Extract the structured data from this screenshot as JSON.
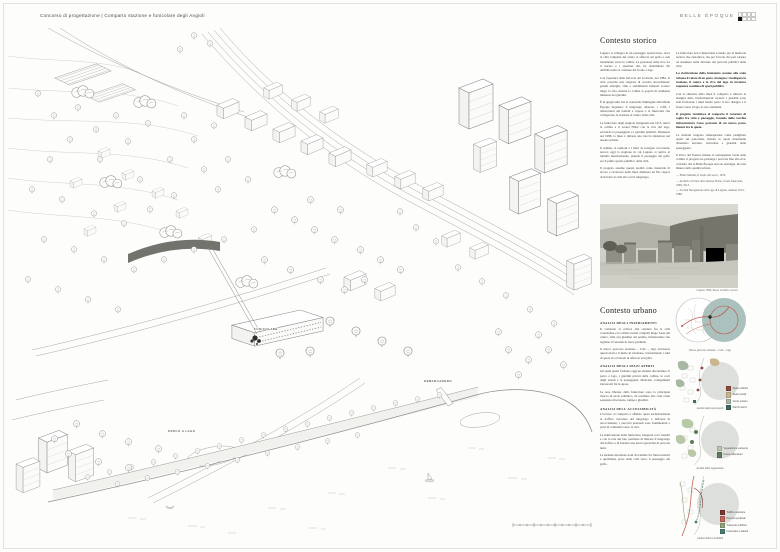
{
  "page": {
    "title": "Concorso di progettazione | Comparto stazione e funicolare degli Angioli",
    "motto": "BELLE ÉPOQUE"
  },
  "drawing": {
    "labels": {
      "funicolare": "FUNICOLARE",
      "debarcadero": "DEBARCADERO",
      "parco": "PARCO A LAGO"
    }
  },
  "historic": {
    "heading": "Contesto storico",
    "col1": [
      "Lugano si sviluppa in un paesaggio spettacolare, dove la città compatta del centro si affaccia sul golfo e sale lentamente verso le colline. La posizione della riva, tra il nucleo e i quartieri alti, ha determinato fin dall'Ottocento il carattere del fronte a lago.",
      "Con l'apertura della ferrovia del Gottardo, nel 1882, la città conobbe una stagione di crescita straordinaria: grandi alberghi, ville e stabilimenti balneari sorsero lungo la riva, mentre la collina si popolò di residenze immerse nei giardini.",
      "È in quegli anni che si consolida l'immagine della Belle Époque luganese: il lungolago alberato, i caffè, i debarcaderi dei battelli a vapore e le funicolari che collegavano la stazione al centro della città.",
      "La funicolare degli Angioli, inaugurata nel 1913, univa la collina e il Grand Hôtel con la riva del lago, servendo la passeggiata e i giardini pubblici. Dismessa nel 1986, la linea è rimasta una traccia silenziosa nel tessuto urbano.",
      "Il sedime, le stazioni e i muri di sostegno raccontano ancora oggi la stagione in cui Lugano si apriva al turismo internazionale, quando il paesaggio del golfo era il primo spazio pubblico della città.",
      "Il progetto assume questa eredità come materiale di lavoro e riconosce nella linea dismessa un filo capace di ricucire la città alta con il lungolago."
    ],
    "col2": [
      "La funicolare non è importante soltanto per la memoria tecnica che custodisce, ma per il ruolo che può tornare ad assumere nella struttura dei percorsi pubblici della città.",
      "La riattivazione della funicolare assume alla scala urbana il valore di un gesto strategico: ricollegare la stazione, il centro e la riva del lago in un'unica sequenza continua di spazi pubblici.",
      "Con la chiusura della linea il comparto è rimasto ai margini delle trasformazioni recenti: i giardini sono stati frazionati, i muri hanno perso il loro disegno e il fronte verso il lago la sua continuità.",
      "Il progetto restituisce al comparto il carattere di soglia fra città e paesaggio, facendo della vecchia infrastruttura l'asse portante di un nuovo parco lineare fra le quote.",
      "Le stazioni vengono reinterpretate come padiglioni aperti sul panorama, mentre le quote intermedie diventano terrazze, belvedere e giardini della passeggiata.",
      "Il Parco del Tassino rimane il contrappunto verde sulla collina: il progetto ne prolunga i percorsi fino alla riva, convinto che la Belle Époque non sia nostalgia, ma una misura della qualità urbana."
    ],
    "footnotes": [
      "— Plinio Martini, Il fondo del sacco, 1970.",
      "— Archivio di Stato del Cantone Ticino, fondo funicolari, 1899–1913.",
      "— Società Navigazione del Lago di Lugano, annuari 1913–1986."
    ],
    "photo_caption": "Lugano 1899, Photo Archivio storico"
  },
  "urban": {
    "heading": "Contesto urbano",
    "s1_title": "ANALISI DEGLI INSEDIAMENTI",
    "s1": [
      "Il comparto si colloca alla cerniera fra la città consolidata e la collina: isolati compatti lungo l'asse del centro, ville con giardino sul pendio, infrastrutture che tagliano il versante in fasce parallele.",
      "Il nuovo percorso stazione – CAC – lago attraversa questi strati e li mette in relazione, trasformando i salti di quota in occasioni di affaccio sul golfo."
    ],
    "s2_title": "ANALISI DEGLI SPAZI APERTI",
    "s2": [
      "Gli spazi aperti formano oggi un sistema discontinuo: il parco a lago, i giardini privati della collina, le corti degli isolati e la passeggiata. Mancano collegamenti trasversali fra le quote.",
      "Le aree liberate dalla funicolare sono la principale riserva di suolo pubblico, da restituire alla città come sequenza di terrazze, rampe e giardini."
    ],
    "s3_title": "ANALISI DELL'ACCESSIBILITÀ",
    "s3": [
      "L'accesso al comparto è affidato quasi esclusivamente al traffico veicolare del lungolago e dell'asse di arroccamento; i percorsi pedonali sono frammentati e privi di continuità verso la riva.",
      "La riattivazione della funicolare, integrata con i battelli e con la rete dei bus, permette di liberare il lungolago dal traffico e di fondare una nuova gerarchia di percorsi lenti.",
      "Le fermate diventano nodi di scambio fra flussi turistici e quotidiani, porte della città verso il paesaggio del golfo."
    ],
    "diagrams": {
      "d1": {
        "caption": "Nuovo percorso stazione – CAC – lago"
      },
      "d2": {
        "caption": "Analisi degli spazi aperti",
        "legend": [
          {
            "color": "#8a4a3e",
            "label": "Spazi pubblici"
          },
          {
            "color": "#c9b68f",
            "label": "Spazi privati"
          },
          {
            "color": "#a9b8a4",
            "label": "Verde urbano"
          },
          {
            "color": "#3d6b5f",
            "label": "Parchi storici"
          }
        ]
      },
      "d3": {
        "caption": "Analisi della vegetazione",
        "legend": [
          {
            "color": "#b9c9a8",
            "label": "Vegetazione esistente"
          },
          {
            "color": "#5d7d5a",
            "label": "Nuove alberature"
          }
        ]
      },
      "d4": {
        "caption": "Analisi dell'accessibilità",
        "legend": [
          {
            "color": "#7c3a32",
            "label": "Traffico veicolare"
          },
          {
            "color": "#c4685a",
            "label": "Percorsi pedonali"
          },
          {
            "color": "#8fa578",
            "label": "Trasporto pubblico"
          },
          {
            "color": "#4a7d74",
            "label": "Funicolare e battelli"
          }
        ]
      }
    }
  },
  "colors": {
    "accent_teal": "#a3bcb7",
    "accent_red": "#bf5347",
    "lake_gray": "#dddfdc"
  }
}
